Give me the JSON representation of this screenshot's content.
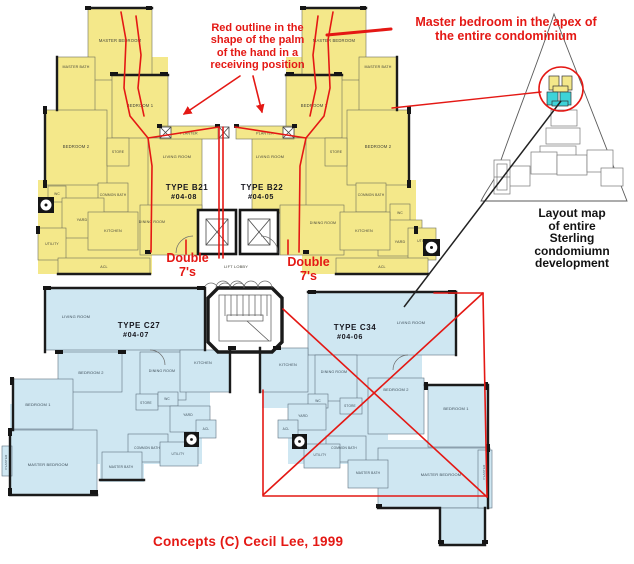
{
  "annotations": {
    "palm_note": "Red outline in the\nshape of the palm\nof the hand in a\nreceiving position",
    "apex_note": "Master bedroom in the apex of\nthe entire condominium",
    "double7_left": "Double\n7's",
    "double7_right": "Double\n7's",
    "layout_caption": "Layout map\nof entire\nSterling\ncondomiumn\ndevelopment",
    "credit": "Concepts (C)  Cecil Lee, 1999"
  },
  "colors": {
    "unit_b_fill": "#f4e88a",
    "unit_c_fill": "#cfe7f2",
    "annotation_red": "#e41814",
    "highlight_cyan": "#3ed3d8"
  },
  "units": {
    "b21": {
      "type_label": "TYPE B21",
      "unit_label": "#04-08",
      "rooms": {
        "master_bedroom": "MASTER BEDROOM",
        "master_bath": "MASTER BATH",
        "bedroom_1": "BEDROOM 1",
        "bedroom_2": "BEDROOM 2",
        "store": "STORE",
        "living_room": "LIVING ROOM",
        "dining_room": "DINING ROOM",
        "common_bath": "COMMON BATH",
        "wc": "WC",
        "yard": "YARD",
        "kitchen": "KITCHEN",
        "utility": "UTILITY",
        "acl": "ACL",
        "planter": "PLANTER"
      }
    },
    "b22": {
      "type_label": "TYPE B22",
      "unit_label": "#04-05",
      "rooms": {
        "master_bedroom": "MASTER BEDROOM",
        "master_bath": "MASTER BATH",
        "bedroom_1": "BEDROOM 1",
        "bedroom_2": "BEDROOM 2",
        "store": "STORE",
        "living_room": "LIVING ROOM",
        "dining_room": "DINING ROOM",
        "common_bath": "COMMON BATH",
        "wc": "WC",
        "yard": "YARD",
        "kitchen": "KITCHEN",
        "utility": "UTILITY",
        "acl": "ACL",
        "planter": "PLANTER"
      }
    },
    "c27": {
      "type_label": "TYPE C27",
      "unit_label": "#04-07",
      "rooms": {
        "living_room": "LIVING ROOM",
        "dining_room": "DINING ROOM",
        "kitchen": "KITCHEN",
        "bedroom_1": "BEDROOM 1",
        "bedroom_2": "BEDROOM 2",
        "master_bedroom": "MASTER BEDROOM",
        "store": "STORE",
        "wc": "WC",
        "yard": "YARD",
        "acl": "ACL",
        "common_bath": "COMMON BATH",
        "master_bath": "MASTER BATH",
        "utility": "UTILITY",
        "planter": "PLANTER"
      }
    },
    "c34": {
      "type_label": "TYPE C34",
      "unit_label": "#04-06",
      "rooms": {
        "living_room": "LIVING ROOM",
        "dining_room": "DINING ROOM",
        "kitchen": "KITCHEN",
        "bedroom_1": "BEDROOM 1",
        "bedroom_2": "BEDROOM 2",
        "master_bedroom": "MASTER BEDROOM",
        "store": "STORE",
        "wc": "WC",
        "yard": "YARD",
        "acl": "ACL",
        "common_bath": "COMMON BATH",
        "master_bath": "MASTER BATH",
        "utility": "UTILITY",
        "planter": "PLANTER"
      }
    },
    "shared": {
      "lift_lobby": "LIFT LOBBY"
    }
  }
}
